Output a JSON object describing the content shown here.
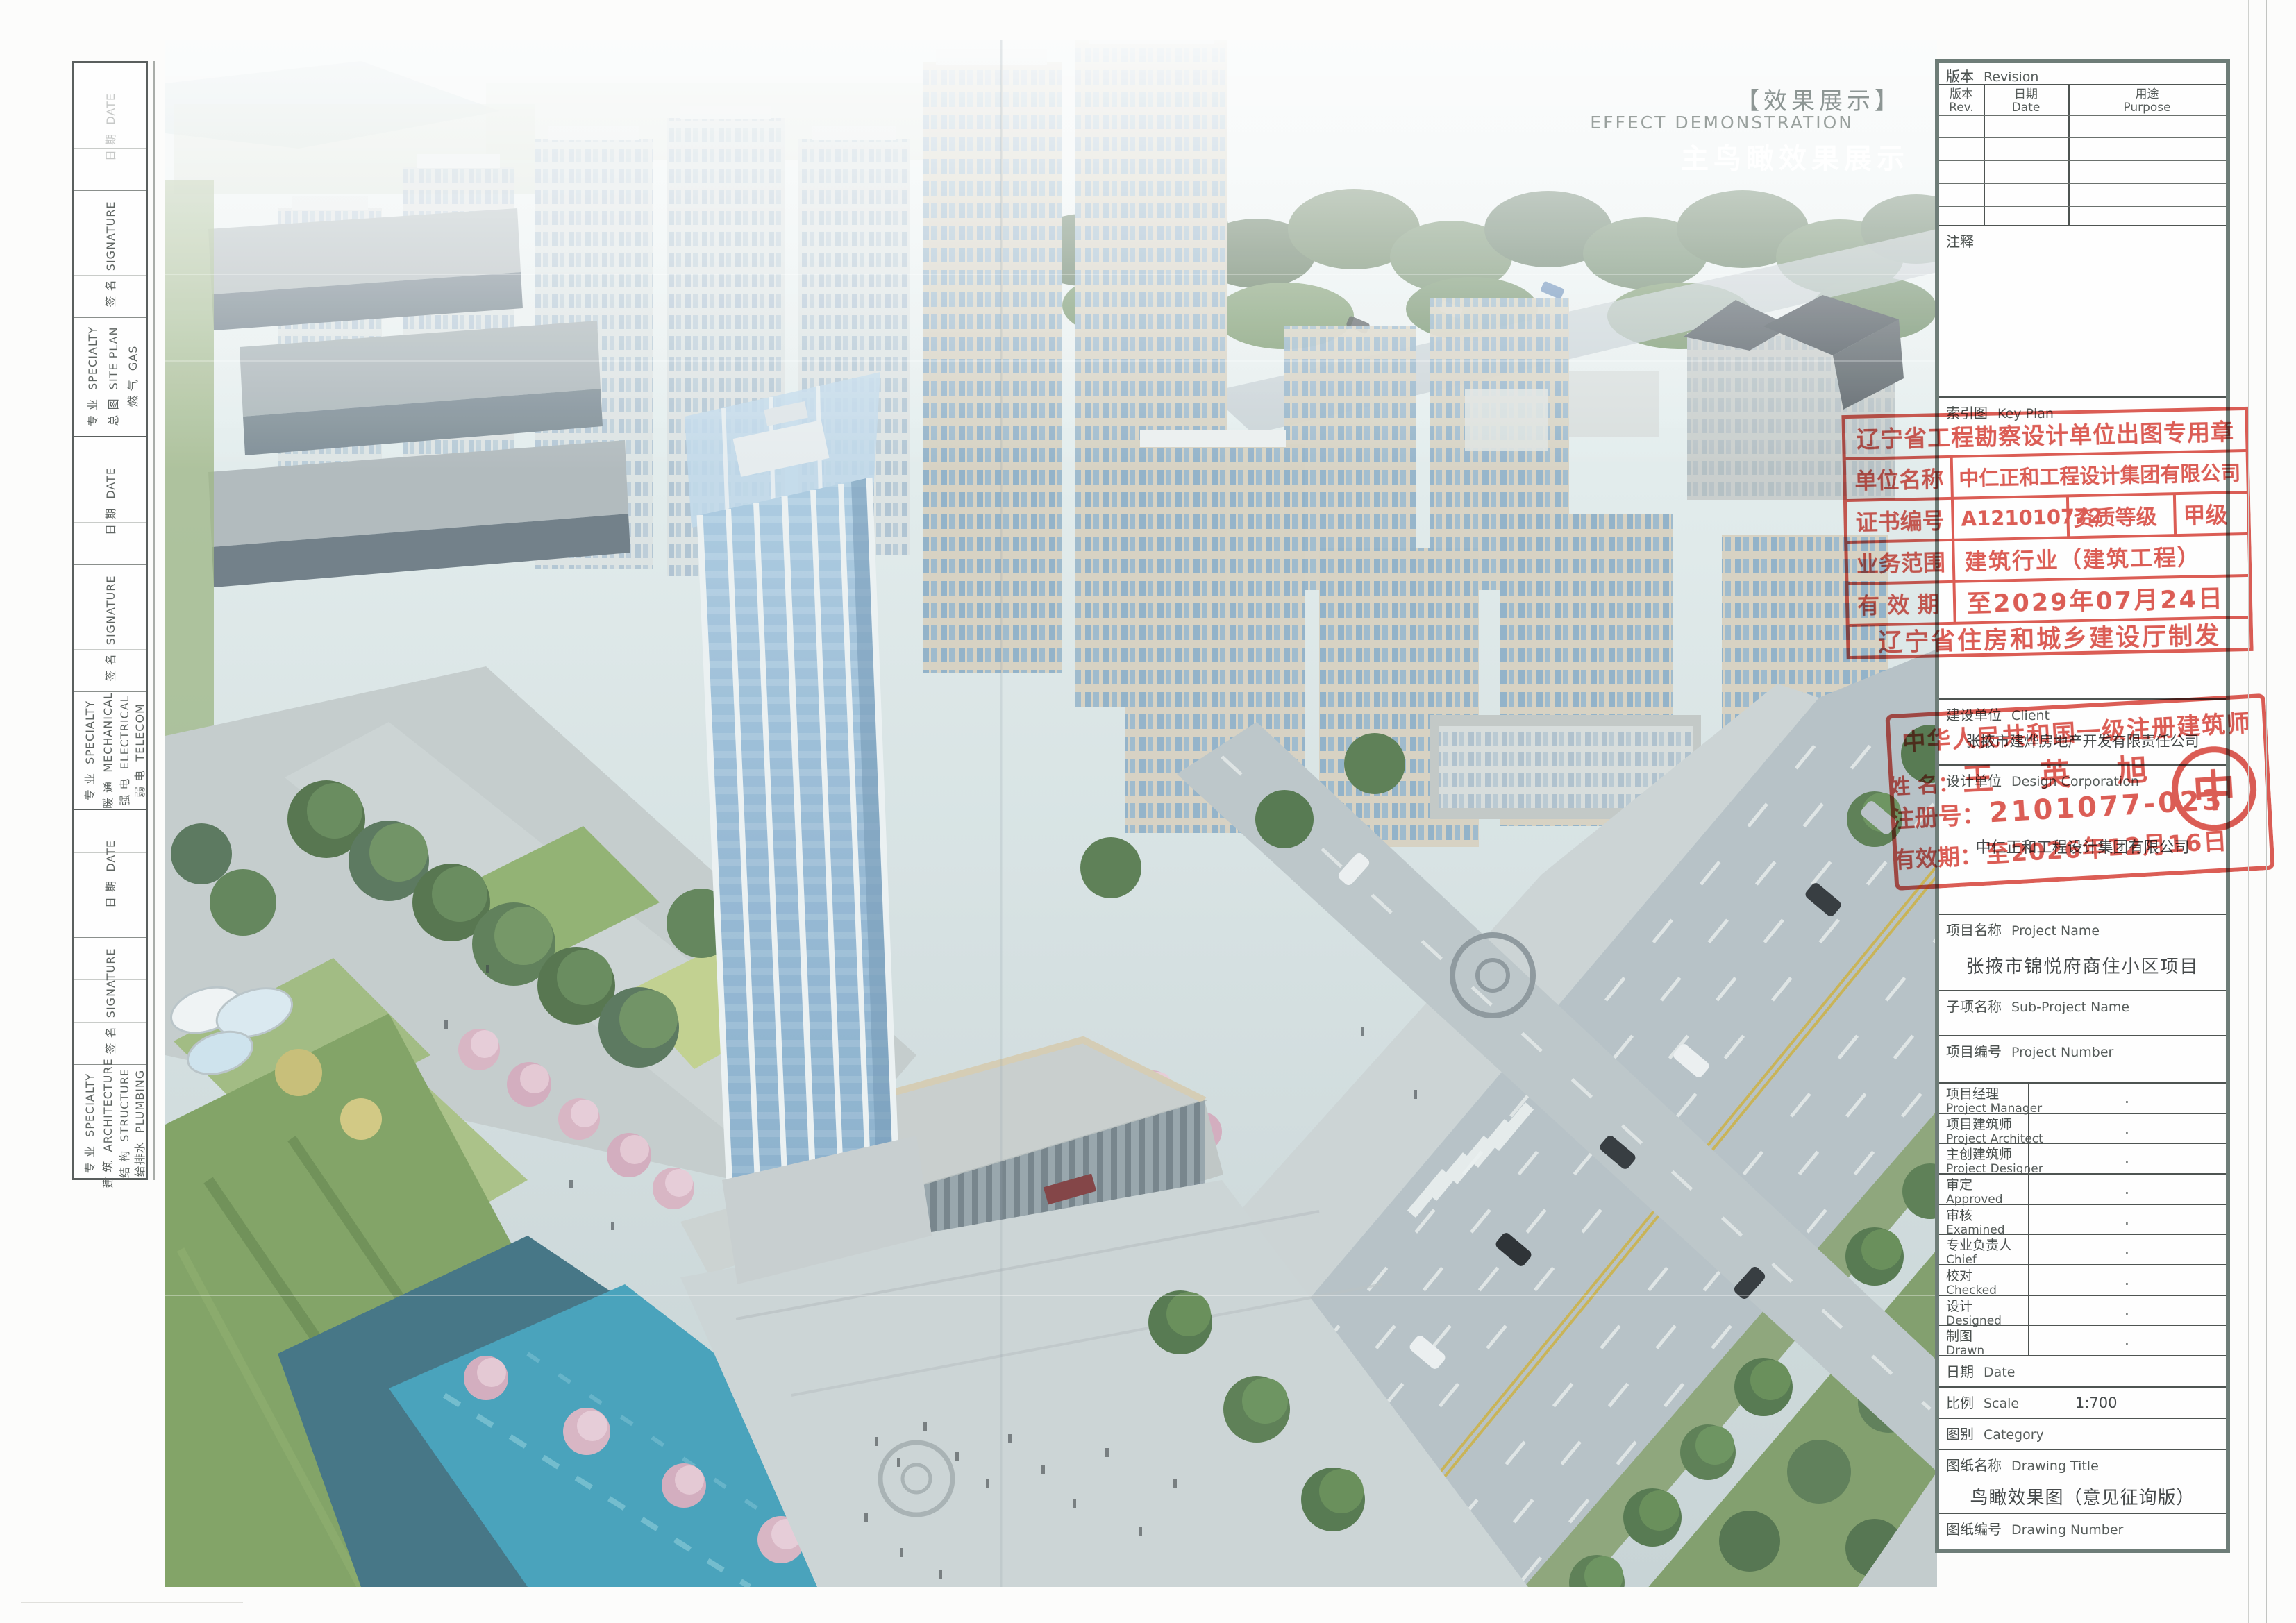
{
  "sheet": {
    "watermark": {
      "cn_bracket": "【效果展示】",
      "en": "EFFECT DEMONSTRATION",
      "cn_white": "主鸟瞰效果展示"
    },
    "signoff": {
      "spec_cn": "专 业",
      "spec_en": "SPECIALTY",
      "sig_cn": "签 名",
      "sig_en": "SIGNATURE",
      "date_cn": "日 期",
      "date_en": "DATE",
      "groups": [
        {
          "items": [
            {
              "cn": "总 图",
              "en": "SITE PLAN"
            },
            {
              "cn": "燃 气",
              "en": "GAS"
            }
          ]
        },
        {
          "items": [
            {
              "cn": "暖 通",
              "en": "MECHANICAL"
            },
            {
              "cn": "强 电",
              "en": "ELECTRICAL"
            },
            {
              "cn": "弱 电",
              "en": "TELECOM"
            }
          ]
        },
        {
          "items": [
            {
              "cn": "建 筑",
              "en": "ARCHITECTURE"
            },
            {
              "cn": "结 构",
              "en": "STRUCTURE"
            },
            {
              "cn": "给排水",
              "en": "PLUMBING"
            }
          ]
        }
      ]
    },
    "titleblock": {
      "revision_cn": "版本",
      "revision_en": "Revision",
      "rev_cn": "版本",
      "rev_en": "Rev.",
      "revdate_cn": "日期",
      "revdate_en": "Date",
      "purpose_cn": "用途",
      "purpose_en": "Purpose",
      "notes_label": "注释",
      "keyplan_cn": "索引图",
      "keyplan_en": "Key Plan",
      "client_cn": "建设单位",
      "client_en": "Client",
      "client_value": "张掖市建烨房地产开发有限责任公司",
      "design_cn": "设计单位",
      "design_en": "Design Corporation",
      "design_value": "中仁正和工程设计集团有限公司",
      "project_cn": "项目名称",
      "project_en": "Project Name",
      "project_value": "张掖市锦悦府商住小区项目",
      "subproject_cn": "子项名称",
      "subproject_en": "Sub-Project Name",
      "projnum_cn": "项目编号",
      "projnum_en": "Project Number",
      "personnel": [
        {
          "cn": "项目经理",
          "en": "Project Manager",
          "value": "."
        },
        {
          "cn": "项目建筑师",
          "en": "Project Architect",
          "value": "."
        },
        {
          "cn": "主创建筑师",
          "en": "Project Designer",
          "value": "."
        },
        {
          "cn": "审定",
          "en": "Approved",
          "value": "."
        },
        {
          "cn": "审核",
          "en": "Examined",
          "value": "."
        },
        {
          "cn": "专业负责人",
          "en": "Chief",
          "value": "."
        },
        {
          "cn": "校对",
          "en": "Checked",
          "value": "."
        },
        {
          "cn": "设计",
          "en": "Designed",
          "value": "."
        },
        {
          "cn": "制图",
          "en": "Drawn",
          "value": "."
        }
      ],
      "date_cn": "日期",
      "date_en": "Date",
      "scale_cn": "比例",
      "scale_en": "Scale",
      "scale_value": "1:700",
      "category_cn": "图别",
      "category_en": "Category",
      "dtitle_cn": "图纸名称",
      "dtitle_en": "Drawing Title",
      "dtitle_value": "鸟瞰效果图（意见征询版）",
      "dnum_cn": "图纸编号",
      "dnum_en": "Drawing Number"
    },
    "stamps": {
      "authority": {
        "title": "辽宁省工程勘察设计单位出图专用章",
        "org_label": "单位名称",
        "org_value": "中仁正和工程设计集团有限公司",
        "cert_label": "证书编号",
        "cert_value": "A121010772",
        "grade_label": "资质等级",
        "grade_value": "甲级",
        "scope_label": "业务范围",
        "scope_value": "建筑行业（建筑工程）",
        "valid_label": "有 效 期",
        "valid_value": "至2029年07月24日",
        "footer": "辽宁省住房和城乡建设厅制发"
      },
      "architect": {
        "title": "中华人民共和国一级注册建筑师",
        "name_label": "姓 名：",
        "name_value": "王 英 旭",
        "reg_label": "注册号：",
        "reg_value": "2101077-023",
        "valid_label": "有效期：",
        "valid_value": "至2026年12月16日"
      }
    },
    "colors": {
      "stamp_red": "#d8463d",
      "water_teal": "#3f9fba",
      "paper": "#fcfcfb"
    }
  }
}
